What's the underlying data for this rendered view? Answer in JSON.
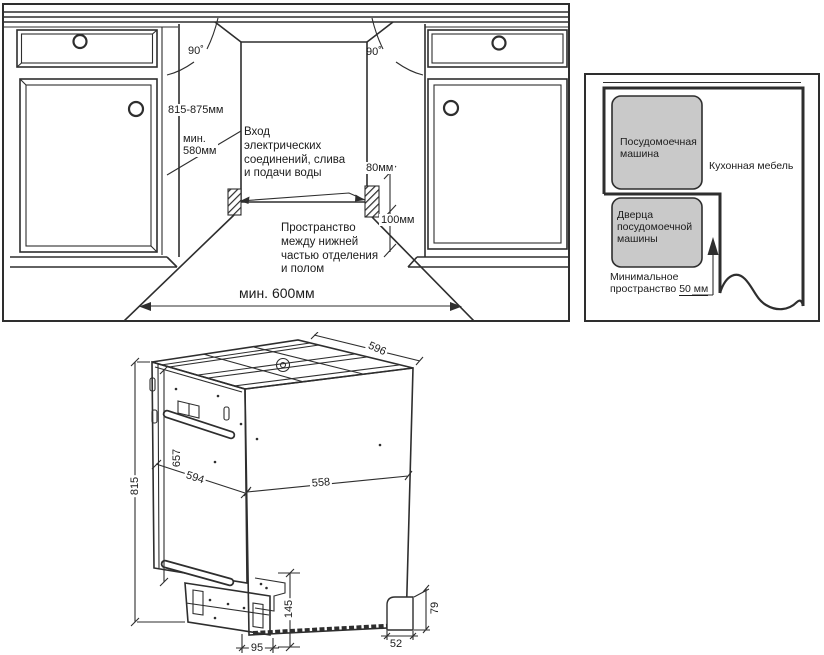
{
  "colors": {
    "line": "#2e2e2e",
    "box_gray": "#c9c9c9"
  },
  "niche_panel": {
    "angle_left": "90˚",
    "angle_right": "90˚",
    "height_range": "815-875мм",
    "min_depth": "мин.\n580мм",
    "inlet_note": "Вход\nэлектрических\nсоединений, слива\nи подачи воды",
    "dim_80": "80мм",
    "dim_100": "100мм",
    "floor_note": "Пространство\nмежду нижней\nчастью отделения\nи полом",
    "min_width": "мин. 600мм"
  },
  "top_view_panel": {
    "dishwasher_label": "Посудомоечная\nмашина",
    "door_label": "Дверца\nпосудомоечной\nмашины",
    "furniture_label": "Кухонная мебель",
    "min_space_line1": "Минимальное",
    "min_space_prefix": "пространство ",
    "min_space_value": "50 мм"
  },
  "dishwasher_drawing": {
    "dims": {
      "top_depth": "596",
      "height": "815",
      "door_height": "657",
      "door_width": "594",
      "side_width": "558",
      "base_height": "145",
      "base_depth": "95",
      "foot_width": "52",
      "foot_height": "79"
    }
  }
}
